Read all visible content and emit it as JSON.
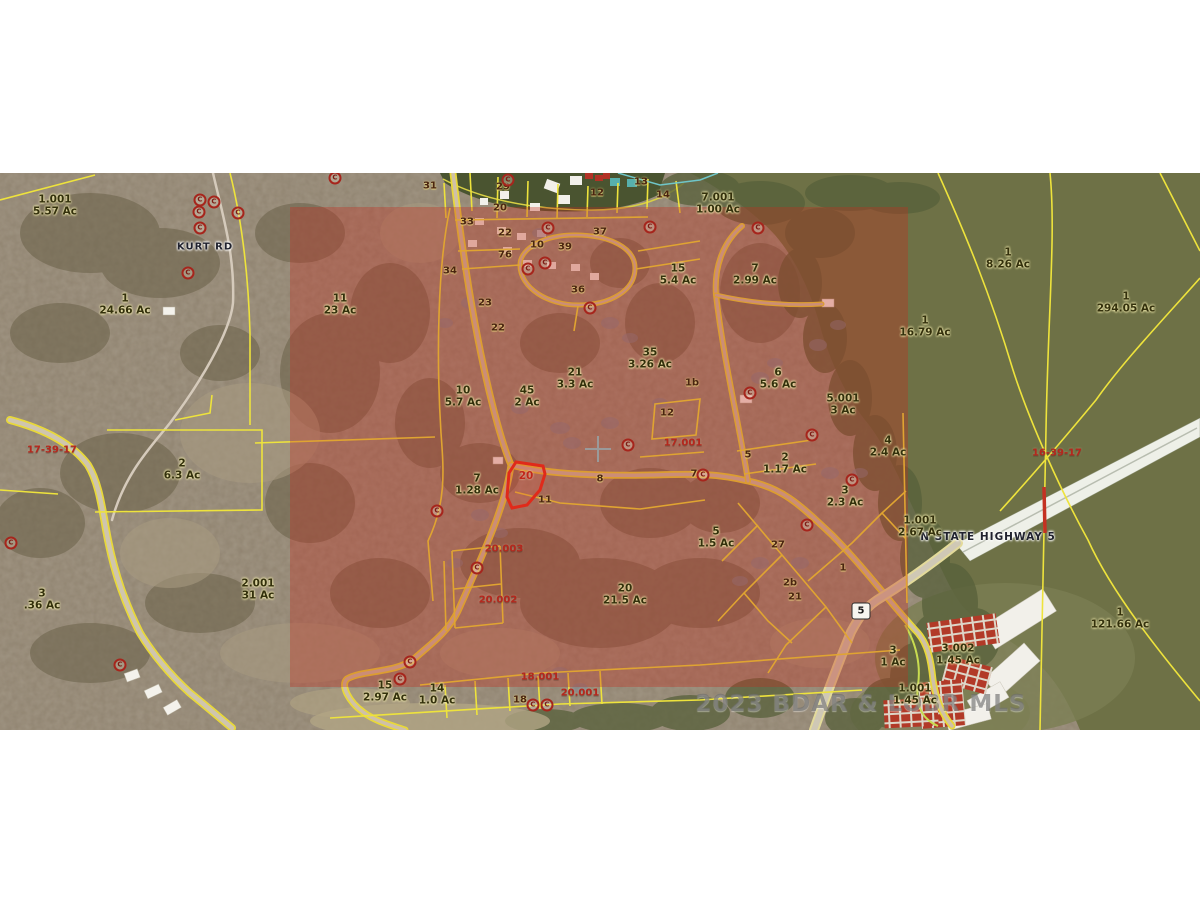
{
  "map": {
    "watermark": "2023 BDAR & LOBR MLS",
    "road_labels": {
      "kurt_rd": "KURT RD",
      "highway": "N STATE HIGHWAY 5"
    },
    "highway_shield": "5",
    "marker_glyph": "C",
    "colors": {
      "overlay_tint": "#c32d1c",
      "parcel_line": "#eee33c",
      "red_accent": "#b5271d",
      "water_lake": "#6e7146",
      "water_inlet": "#4a5430",
      "land": "#8f8370",
      "highlight_outline": "#e02a1a",
      "watermark_gray": "#696969"
    },
    "highlight_parcel": {
      "label": "20",
      "x": 526,
      "y": 303
    },
    "parcel_labels": [
      {
        "x": 55,
        "y": 33,
        "lot": "1.001",
        "acres": "5.57 Ac"
      },
      {
        "x": 125,
        "y": 132,
        "lot": "1",
        "acres": "24.66 Ac"
      },
      {
        "x": 182,
        "y": 297,
        "lot": "2",
        "acres": "6.3 Ac"
      },
      {
        "x": 42,
        "y": 427,
        "lot": "3",
        "acres": ".36 Ac"
      },
      {
        "x": 258,
        "y": 417,
        "lot": "2.001",
        "acres": "31 Ac"
      },
      {
        "x": 340,
        "y": 132,
        "lot": "11",
        "acres": "23 Ac"
      },
      {
        "x": 718,
        "y": 31,
        "lot": "7.001",
        "acres": "1.00 Ac"
      },
      {
        "x": 678,
        "y": 102,
        "lot": "15",
        "acres": "5.4 Ac"
      },
      {
        "x": 755,
        "y": 102,
        "lot": "7",
        "acres": "2.99 Ac"
      },
      {
        "x": 1008,
        "y": 86,
        "lot": "1",
        "acres": "8.26 Ac"
      },
      {
        "x": 1126,
        "y": 130,
        "lot": "1",
        "acres": "294.05 Ac"
      },
      {
        "x": 925,
        "y": 154,
        "lot": "1",
        "acres": "16.79 Ac"
      },
      {
        "x": 650,
        "y": 186,
        "lot": "35",
        "acres": "3.26 Ac"
      },
      {
        "x": 575,
        "y": 206,
        "lot": "21",
        "acres": "3.3 Ac"
      },
      {
        "x": 778,
        "y": 206,
        "lot": "6",
        "acres": "5.6 Ac"
      },
      {
        "x": 843,
        "y": 232,
        "lot": "5.001",
        "acres": "3 Ac"
      },
      {
        "x": 463,
        "y": 224,
        "lot": "10",
        "acres": "5.7 Ac"
      },
      {
        "x": 527,
        "y": 224,
        "lot": "45",
        "acres": "2 Ac"
      },
      {
        "x": 888,
        "y": 274,
        "lot": "4",
        "acres": "2.4 Ac"
      },
      {
        "x": 785,
        "y": 291,
        "lot": "2",
        "acres": "1.17 Ac"
      },
      {
        "x": 845,
        "y": 324,
        "lot": "3",
        "acres": "2.3 Ac"
      },
      {
        "x": 477,
        "y": 312,
        "lot": "7",
        "acres": "1.28 Ac"
      },
      {
        "x": 716,
        "y": 365,
        "lot": "5",
        "acres": "1.5 Ac"
      },
      {
        "x": 625,
        "y": 422,
        "lot": "20",
        "acres": "21.5 Ac"
      },
      {
        "x": 385,
        "y": 519,
        "lot": "15",
        "acres": "2.97 Ac"
      },
      {
        "x": 437,
        "y": 522,
        "lot": "14",
        "acres": "1.0 Ac"
      },
      {
        "x": 893,
        "y": 484,
        "lot": "3",
        "acres": "1 Ac"
      },
      {
        "x": 958,
        "y": 482,
        "lot": "3.002",
        "acres": "1.45 Ac"
      },
      {
        "x": 915,
        "y": 522,
        "lot": "1.001",
        "acres": "1.45 Ac"
      },
      {
        "x": 920,
        "y": 354,
        "lot": "1.001",
        "acres": "2.67 Ac"
      },
      {
        "x": 1120,
        "y": 446,
        "lot": "1",
        "acres": "121.66 Ac"
      }
    ],
    "lot_numbers": [
      {
        "x": 430,
        "y": 13,
        "t": "31"
      },
      {
        "x": 503,
        "y": 14,
        "t": "29"
      },
      {
        "x": 597,
        "y": 20,
        "t": "12"
      },
      {
        "x": 641,
        "y": 9,
        "t": "13"
      },
      {
        "x": 663,
        "y": 22,
        "t": "14"
      },
      {
        "x": 500,
        "y": 35,
        "t": "20"
      },
      {
        "x": 467,
        "y": 49,
        "t": "33"
      },
      {
        "x": 505,
        "y": 60,
        "t": "22"
      },
      {
        "x": 537,
        "y": 72,
        "t": "10"
      },
      {
        "x": 565,
        "y": 74,
        "t": "39"
      },
      {
        "x": 600,
        "y": 59,
        "t": "37"
      },
      {
        "x": 505,
        "y": 82,
        "t": "76"
      },
      {
        "x": 450,
        "y": 98,
        "t": "34"
      },
      {
        "x": 578,
        "y": 117,
        "t": "36"
      },
      {
        "x": 485,
        "y": 130,
        "t": "23"
      },
      {
        "x": 498,
        "y": 155,
        "t": "22"
      },
      {
        "x": 692,
        "y": 210,
        "t": "1b"
      },
      {
        "x": 667,
        "y": 240,
        "t": "12"
      },
      {
        "x": 748,
        "y": 282,
        "t": "5"
      },
      {
        "x": 694,
        "y": 301,
        "t": "7"
      },
      {
        "x": 600,
        "y": 306,
        "t": "8"
      },
      {
        "x": 545,
        "y": 327,
        "t": "11"
      },
      {
        "x": 778,
        "y": 372,
        "t": "27"
      },
      {
        "x": 843,
        "y": 395,
        "t": "1"
      },
      {
        "x": 790,
        "y": 410,
        "t": "2b"
      },
      {
        "x": 795,
        "y": 424,
        "t": "21"
      },
      {
        "x": 520,
        "y": 527,
        "t": "18"
      }
    ],
    "red_labels": [
      {
        "x": 52,
        "y": 277,
        "t": "17-39-17"
      },
      {
        "x": 1057,
        "y": 280,
        "t": "16-39-17"
      },
      {
        "x": 504,
        "y": 376,
        "t": "20.003"
      },
      {
        "x": 498,
        "y": 427,
        "t": "20.002"
      },
      {
        "x": 540,
        "y": 504,
        "t": "18.001"
      },
      {
        "x": 580,
        "y": 520,
        "t": "20.001"
      },
      {
        "x": 683,
        "y": 270,
        "t": "17.001"
      }
    ],
    "markers": [
      {
        "x": 200,
        "y": 27
      },
      {
        "x": 214,
        "y": 29
      },
      {
        "x": 199,
        "y": 39
      },
      {
        "x": 200,
        "y": 55
      },
      {
        "x": 238,
        "y": 40
      },
      {
        "x": 188,
        "y": 100
      },
      {
        "x": 11,
        "y": 370
      },
      {
        "x": 120,
        "y": 492
      },
      {
        "x": 335,
        "y": 5
      },
      {
        "x": 508,
        "y": 7
      },
      {
        "x": 548,
        "y": 55
      },
      {
        "x": 650,
        "y": 54
      },
      {
        "x": 758,
        "y": 55
      },
      {
        "x": 545,
        "y": 90
      },
      {
        "x": 528,
        "y": 96
      },
      {
        "x": 590,
        "y": 135
      },
      {
        "x": 750,
        "y": 220
      },
      {
        "x": 812,
        "y": 262
      },
      {
        "x": 628,
        "y": 272
      },
      {
        "x": 437,
        "y": 338
      },
      {
        "x": 703,
        "y": 302
      },
      {
        "x": 477,
        "y": 395
      },
      {
        "x": 852,
        "y": 307
      },
      {
        "x": 807,
        "y": 352
      },
      {
        "x": 410,
        "y": 489
      },
      {
        "x": 400,
        "y": 506
      },
      {
        "x": 533,
        "y": 532
      },
      {
        "x": 547,
        "y": 532
      }
    ]
  }
}
